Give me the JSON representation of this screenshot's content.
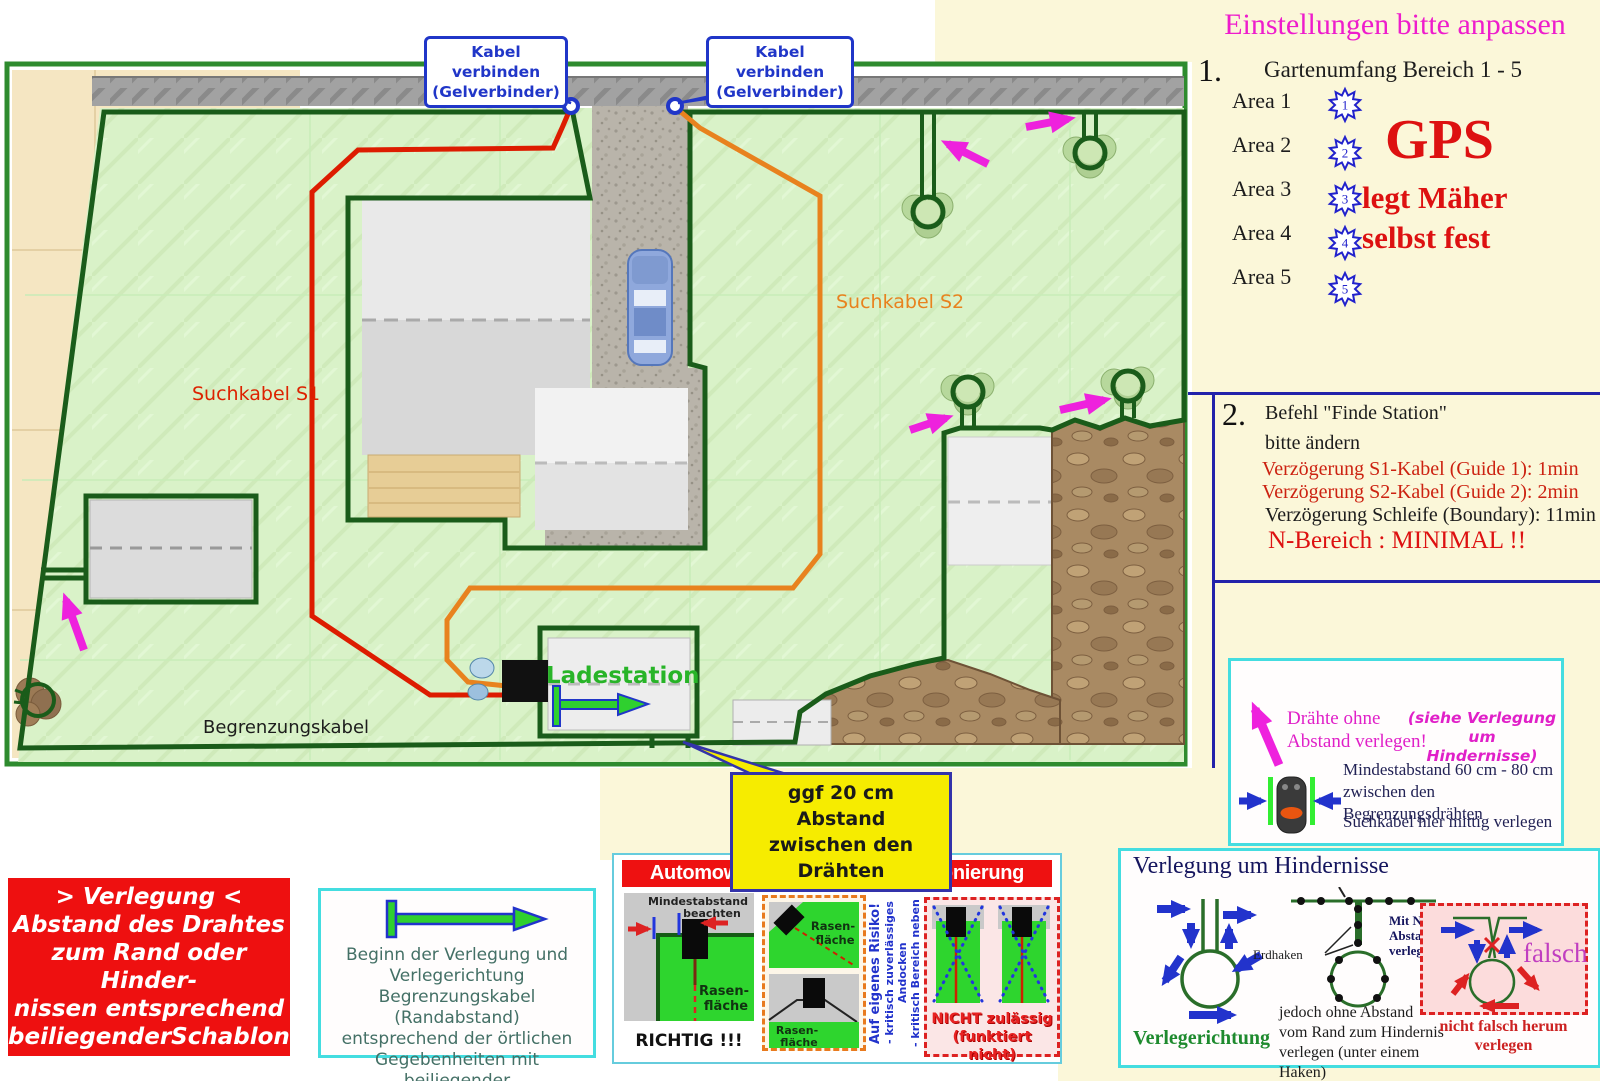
{
  "map": {
    "callout1": {
      "line1": "Kabel verbinden",
      "line2": "(Gelverbinder)"
    },
    "callout2": {
      "line1": "Kabel verbinden",
      "line2": "(Gelverbinder)"
    },
    "suchkabel_s1": "Suchkabel S1",
    "suchkabel_s2": "Suchkabel S2",
    "begrenzungskabel": "Begrenzungskabel",
    "ladestation": "Ladestation",
    "yellow_note": {
      "line1": "ggf 20 cm Abstand",
      "line2": "zwischen den Drähten"
    }
  },
  "settings": {
    "title": "Einstellungen bitte anpassen",
    "step1_num": "1.",
    "step1_heading": "Gartenumfang Bereich 1 - 5",
    "areas": [
      {
        "label": "Area 1",
        "num": "1"
      },
      {
        "label": "Area 2",
        "num": "2"
      },
      {
        "label": "Area 3",
        "num": "3"
      },
      {
        "label": "Area 4",
        "num": "4"
      },
      {
        "label": "Area 5",
        "num": "5"
      }
    ],
    "gps_big": "GPS",
    "gps_line1": "legt Mäher",
    "gps_line2": "selbst fest",
    "step2_num": "2.",
    "step2_title": "Befehl \"Finde Station\"",
    "step2_subtitle": "bitte ändern",
    "delay_s1": "Verzögerung S1-Kabel (Guide 1): 1min",
    "delay_s2": "Verzögerung S2-Kabel (Guide 2): 2min",
    "delay_loop": "Verzögerung Schleife (Boundary): 11min",
    "n_bereich": "N-Bereich : MINIMAL !!"
  },
  "wire_note": {
    "note_line1": "Drähte ohne",
    "note_line2": "Abstand verlegen!",
    "ref_line1": "(siehe Verlegung um",
    "ref_line2": "Hindernisse)",
    "dist_line1": "Mindestabstand 60 cm - 80 cm",
    "dist_line2": "zwischen den Begrenzungsdrähten",
    "center_note": "Suchkabel hier mittig verlegen"
  },
  "verlegung": {
    "lines": [
      "> Verlegung <",
      "Abstand des Drahtes",
      "zum Rand oder Hinder-",
      "nissen entsprechend",
      "beiliegenderSchablone"
    ]
  },
  "beginn": {
    "lines": [
      "Beginn der Verlegung und",
      "Verlegerichtung",
      "Begrenzungskabel (Randabstand)",
      "entsprechend der örtlichen",
      "Gegebenheiten mit beiliegender",
      "Schablone verlegen"
    ]
  },
  "positioning": {
    "title": "Automower Ladestation - Positionierung",
    "correct": {
      "hint1": "Mindestabstand",
      "hint2": "beachten",
      "lawn1": "Rasen-",
      "lawn2": "fläche",
      "verdict": "RICHTIG !!!"
    },
    "risk": {
      "lawn_a1": "Rasen-",
      "lawn_a2": "fläche",
      "lawn_b1": "Rasen-",
      "lawn_b2": "fläche",
      "warn1": "Auf eigenes Risiko!",
      "warn2": "- kritisch zuverlässiges Andocken",
      "warn3": "- kritisch Bereich neben Ladestation"
    },
    "forbidden": {
      "line1": "NICHT zulässig",
      "line2": "(funktiert nicht)"
    }
  },
  "obstacles": {
    "title": "Verlegung um Hindernisse",
    "erdhaken": "Erdhaken",
    "zero1": "Mit Null",
    "zero2": "Abstand",
    "zero3": "verlegen",
    "direction": "Verlegerichtung",
    "note1": "jedoch ohne Abstand",
    "note2": "vom Rand zum Hindernis",
    "note3": "verlegen (unter einem Haken)",
    "wrong": "falsch",
    "wrong_note1": "nicht falsch herum",
    "wrong_note2": "verlegen"
  },
  "colors": {
    "wire_green": "#1a5c1a",
    "s1_red": "#dd1c00",
    "s2_orange": "#e8821e",
    "callout_blue": "#2036c8",
    "accent_magenta": "#ee22dd",
    "box_red": "#ee1010",
    "cyan_border": "#44dde0",
    "yellow_note": "#f6ec00",
    "cream": "#fbf7d9"
  }
}
